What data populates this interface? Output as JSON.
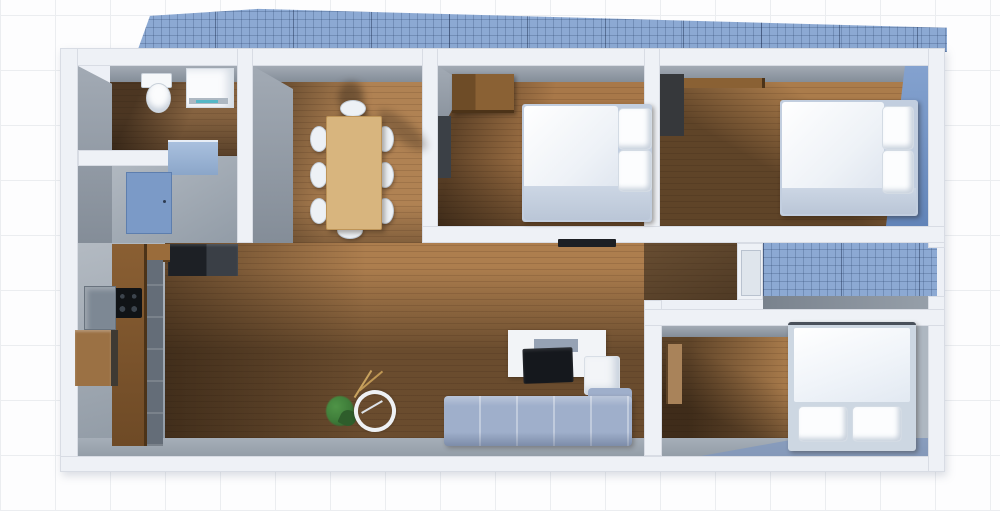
{
  "scene": {
    "kind": "3d-floor-plan-top-view",
    "style": "rendered apartment model on blue graph paper",
    "visible_text": "none",
    "no_ui_chrome": true
  },
  "palette": {
    "paper": "#fdfdfe",
    "paper_grid_line": "#ebedf0",
    "outdoor_grid_fill": "#8ca9d3",
    "outdoor_grid_line": "#2f466e",
    "wall_white": "#eef1f6",
    "wall_inner_gray": "#98a1ac",
    "wood_light": "#b08253",
    "wood_shadowed": "#5f4328",
    "kitchen_floor_gray": "#9aa4ae",
    "accent_wall_blue": "#7e9dcc",
    "door_blue": "#7b9ac7",
    "sofa_blue_gray": "#9fafcb",
    "bed_white": "#f7f9fc",
    "bed_frame": "#c2cedf",
    "table_wood": "#d8b57e",
    "appliance_black": "#25282d",
    "plant_green": "#3e7c39"
  },
  "outdoor": {
    "terrace": {
      "name": "Terrace (blue grid surface, top)"
    },
    "lightwell": {
      "name": "Light well (blue grid notch, right)"
    }
  },
  "rooms": {
    "bathroom": {
      "name": "Bathroom",
      "furniture": [
        "toilet",
        "washing machine",
        "vanity counter"
      ]
    },
    "entry": {
      "name": "Entry hall",
      "furniture": [
        "blue entry door",
        "fridge"
      ]
    },
    "kitchen": {
      "name": "Kitchen",
      "furniture": [
        "wood counter run",
        "cooktop with 4 burners",
        "sink block",
        "wall shelf"
      ]
    },
    "dining": {
      "name": "Dining area",
      "furniture": [
        "wood dining table",
        "8 white chairs"
      ],
      "chair_count": 8
    },
    "living": {
      "name": "Living room",
      "furniture": [
        "L-shaped sofa",
        "white ottoman",
        "TV board",
        "TV",
        "wall TV",
        "potted plant",
        "wheel decor"
      ]
    },
    "bedroom1": {
      "name": "Bedroom 1 (top middle)",
      "furniture": [
        "double bed with 2 pillows",
        "dresser",
        "open dark door"
      ]
    },
    "bedroom2": {
      "name": "Bedroom 2 (top right, blue accent wall)",
      "furniture": [
        "double bed with 2 pillows",
        "dark wardrobe",
        "wall shelf"
      ]
    },
    "bedroom3": {
      "name": "Bedroom 3 (bottom right)",
      "furniture": [
        "double bed with 2 pillows (head at bottom)",
        "open wood door"
      ]
    },
    "hallway": {
      "name": "Hallway to light well",
      "furniture": [
        "white exterior door"
      ]
    }
  }
}
